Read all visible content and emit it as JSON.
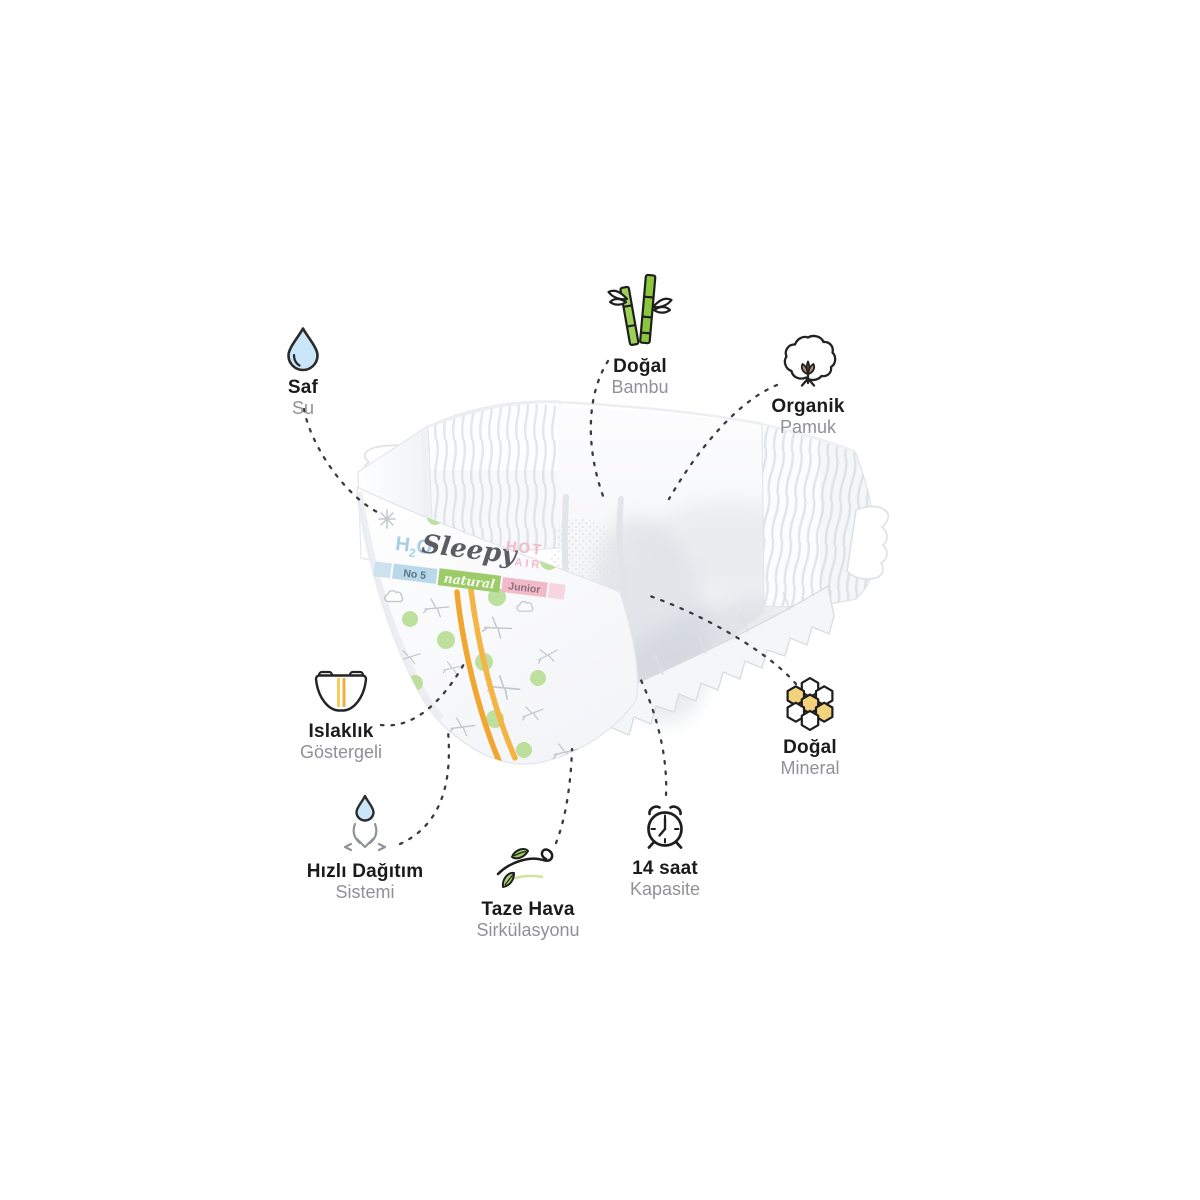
{
  "diaper": {
    "h2o": {
      "h": "H",
      "sub": "2",
      "o": "O"
    },
    "brand_script": "Sleepy",
    "hot": "HOT",
    "air": "AIR",
    "size_label": "No 5",
    "natural_label": "natural",
    "stage_label": "Junior",
    "colors": {
      "h2o_blue": "#a9cfe5",
      "hot_pink": "#f4bac8",
      "band_blue": "#b9d8ea",
      "band_green": "#9ecb6a",
      "band_pink": "#f2bac8",
      "dot_green": "#b7dd94",
      "stripe_orange": "#f3ab33",
      "brand_gray": "#5c5c64"
    }
  },
  "features": [
    {
      "id": "saf-su",
      "title": "Saf",
      "subtitle": "Su",
      "icon": "water-drop-icon"
    },
    {
      "id": "dogal-bambu",
      "title": "Doğal",
      "subtitle": "Bambu",
      "icon": "bamboo-icon"
    },
    {
      "id": "organik-pamuk",
      "title": "Organik",
      "subtitle": "Pamuk",
      "icon": "cotton-icon"
    },
    {
      "id": "islaklik-gostergeli",
      "title": "Islaklık",
      "subtitle": "Göstergeli",
      "icon": "wetness-indicator-diaper-icon"
    },
    {
      "id": "dogal-mineral",
      "title": "Doğal",
      "subtitle": "Mineral",
      "icon": "honeycomb-icon"
    },
    {
      "id": "hizli-dagitim",
      "title": "Hızlı Dağıtım",
      "subtitle": "Sistemi",
      "icon": "drop-distribution-icon"
    },
    {
      "id": "taze-hava",
      "title": "Taze Hava",
      "subtitle": "Sirkülasyonu",
      "icon": "fresh-air-leaves-icon"
    },
    {
      "id": "14-saat",
      "title": "14 saat",
      "subtitle": "Kapasite",
      "icon": "alarm-clock-icon"
    }
  ]
}
